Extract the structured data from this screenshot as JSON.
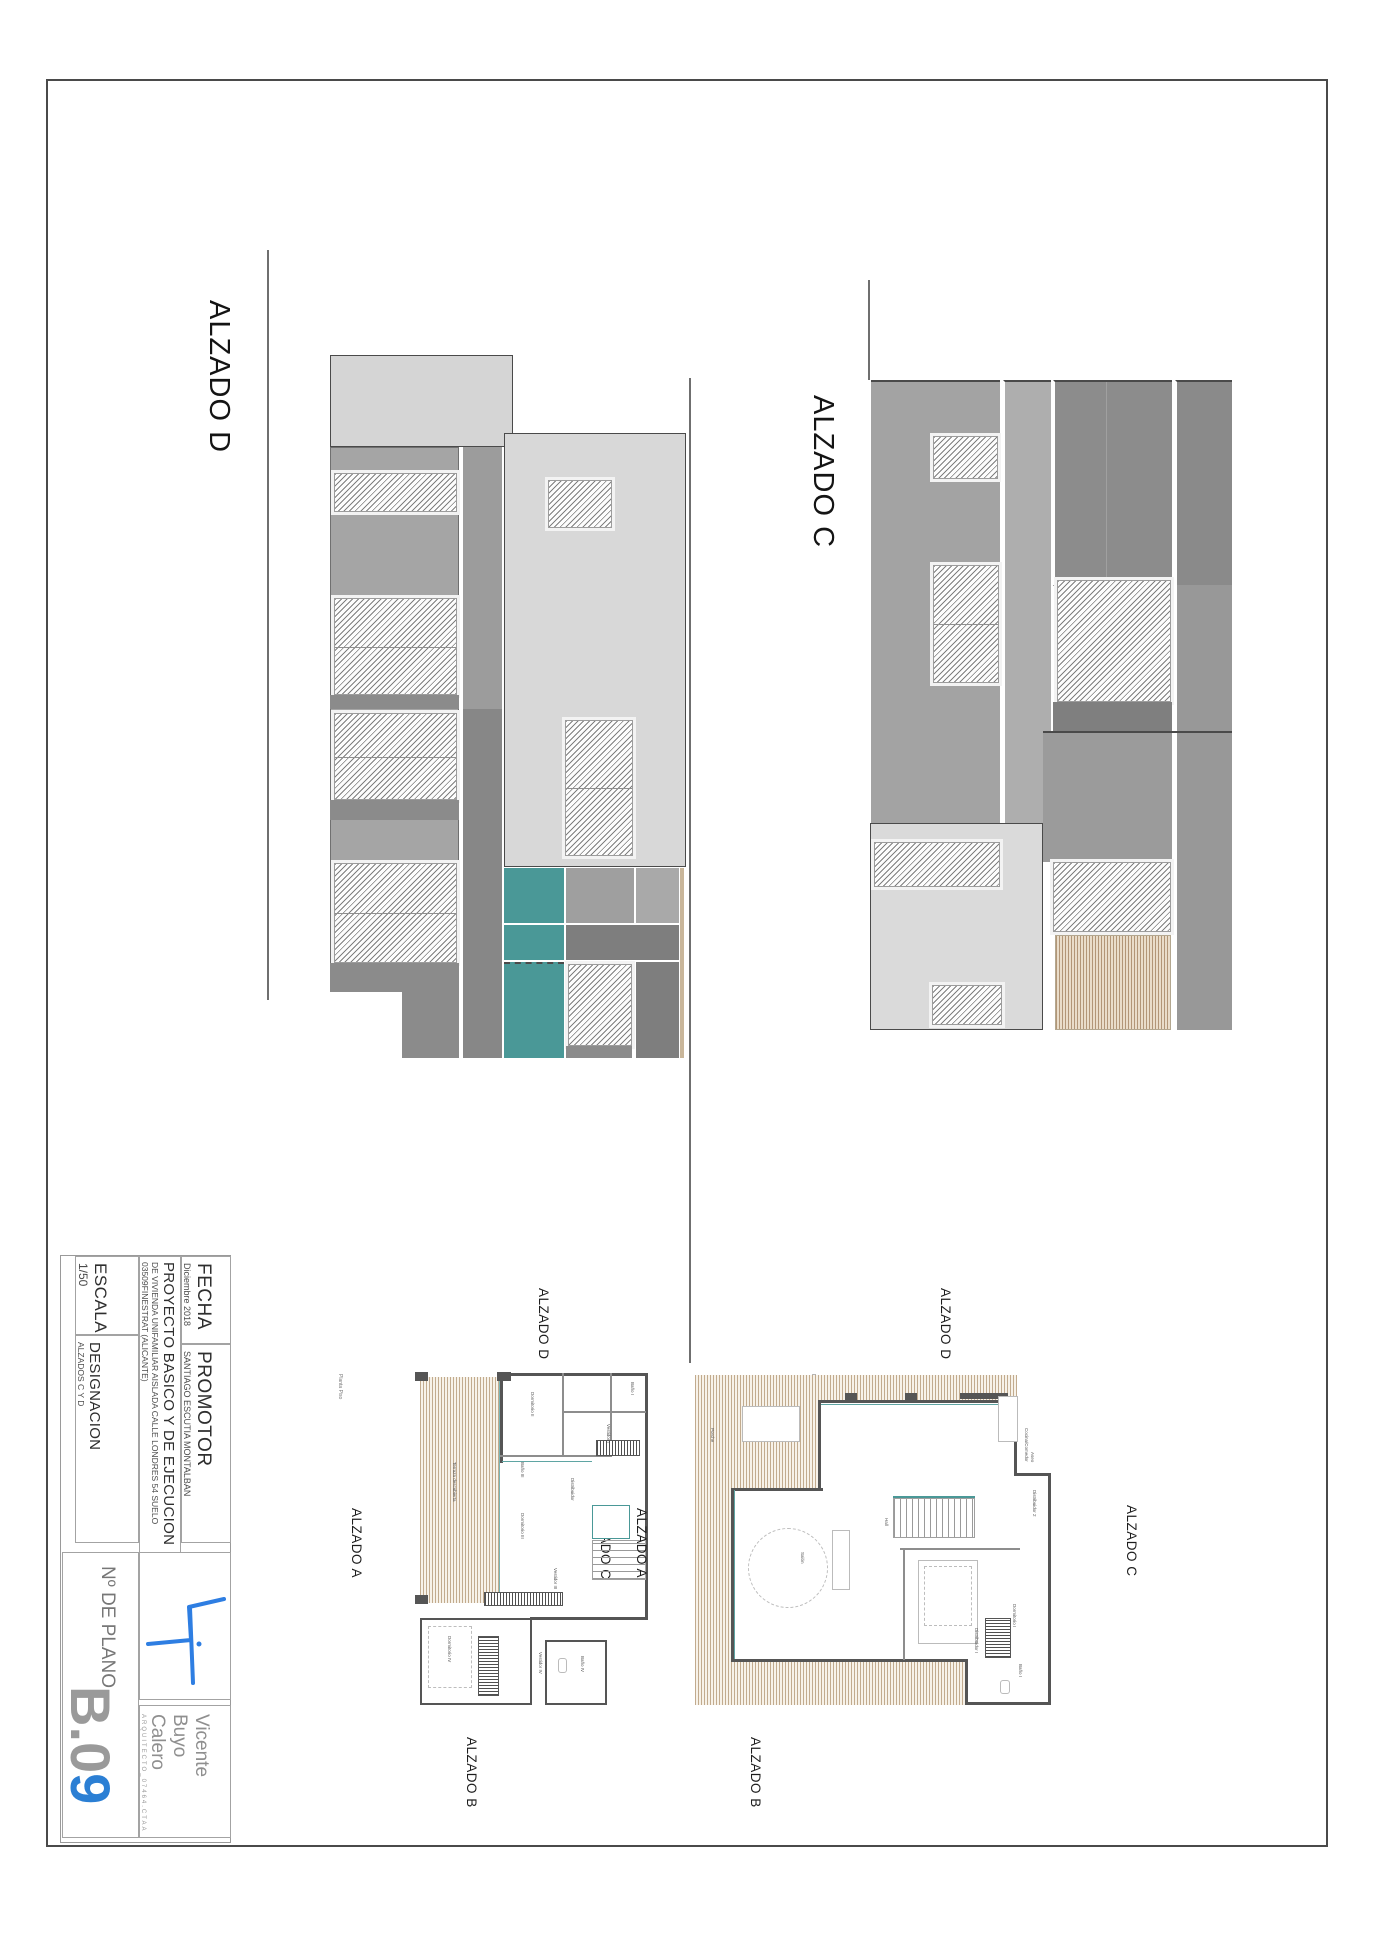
{
  "elevations": [
    {
      "label": "ALZADO D"
    },
    {
      "label": "ALZADO C"
    }
  ],
  "plans": [
    {
      "name": "Planta Piso",
      "corner_labels": {
        "top": "ALZADO D",
        "left": "ALZADO A",
        "right": "ALZADO C",
        "bottom": "ALZADO B"
      },
      "room_labels": [
        "Terraza descubierta",
        "Dormitorio II",
        "Baño I",
        "Vestidor I",
        "Distribuidor",
        "Baño III",
        "Dormitorio III",
        "Vestidor III",
        "Dormitorio IV",
        "Vestidor IV",
        "Baño IV"
      ]
    },
    {
      "name": "Planta Baja",
      "corner_labels": {
        "top": "ALZADO D",
        "left": "ALZADO A",
        "right": "ALZADO C",
        "bottom": "ALZADO B"
      },
      "room_labels": [
        "Porche",
        "Cocina/Comedor",
        "Aseo",
        "Distribuidor 2",
        "Hall",
        "Salón",
        "Dormitorio I",
        "Distribuidor I",
        "Baño I"
      ]
    }
  ],
  "title_block": {
    "fecha_label": "FECHA",
    "fecha_value": "Diciembre 2018",
    "promotor_label": "PROMOTOR",
    "promotor_value": "SANTIAGO ESCUTIA MONTALBAN",
    "proyecto_title": "PROYECTO BASICO Y DE EJECUCION",
    "proyecto_line2": "DE VIVIENDA UNIFAMILIAR AISLADA CALLE LONDRES 54 SUELO",
    "proyecto_line3": "03509FINESTRAT (ALICANTE)",
    "escala_label": "ESCALA",
    "escala_value": "1/50",
    "designacion_label": "DESIGNACION",
    "designacion_value": "ALZADOS C Y D",
    "plano_label": "Nº DE PLANO",
    "plano_number_prefix": "B.0",
    "plano_number_suffix": "9",
    "architect_line1": "Vicente",
    "architect_line2": "Buyo",
    "architect_line3": "Calero",
    "architect_credentials": "ARQUITECTO_07464.CTAA"
  },
  "colors": {
    "teal": "#4a9897",
    "wood": "#b29677",
    "accent_blue": "#2b7fd4",
    "light_gray": "#d5d5d5",
    "medium_gray": "#a5a5a5",
    "dark_gray": "#7e7e7e"
  }
}
